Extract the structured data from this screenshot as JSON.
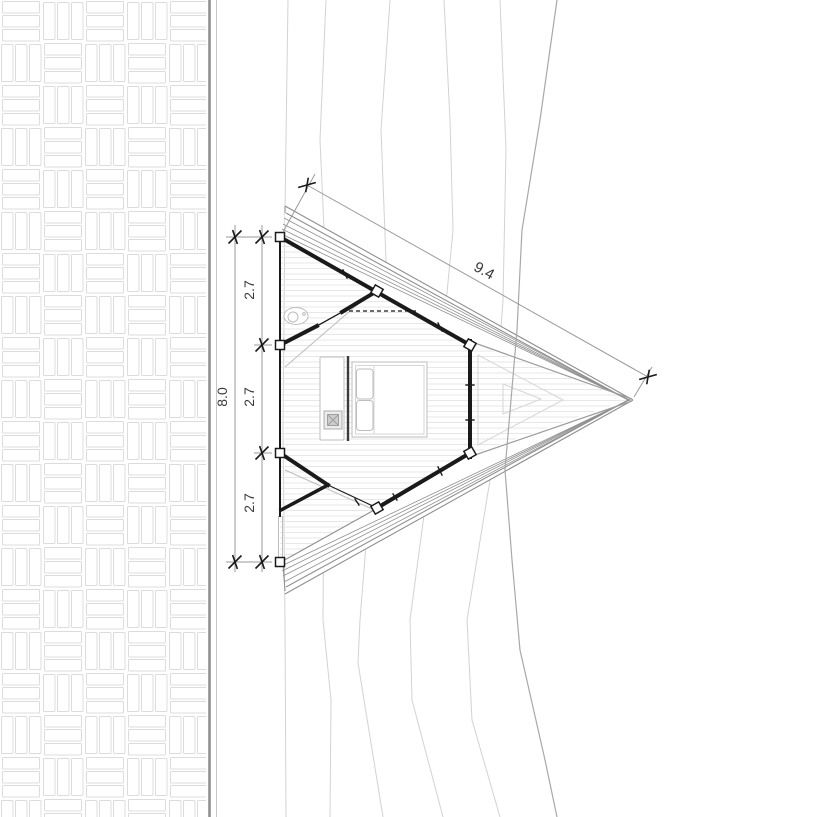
{
  "drawing": {
    "type": "architectural-plan",
    "description": "Plan of a triangular A-frame cabin on a pointed deck beside a paved road, with terrain contour lines",
    "dimensions": {
      "left_total": "8.0",
      "left_segments": [
        "2.7",
        "2.7",
        "2.7"
      ],
      "roof_edge": "9.4"
    },
    "colors": {
      "paper": "#ffffff",
      "wall": "#1a1a1a",
      "deck_edge": "#8f8f8f",
      "roof_line": "#9c9c9c",
      "glass_line": "#d6d6d6",
      "contour": "#d2d2d2",
      "contour_dark": "#a8a8a8",
      "board": "#e7e7e7",
      "furniture": "#bdbdbd",
      "dark_furniture": "#3c3c3c",
      "hatch": "#dcdcdc",
      "road_line_light": "#c6c6c6",
      "dim_line": "#9a9a9a",
      "dim_text": "#3a3a3a"
    }
  }
}
